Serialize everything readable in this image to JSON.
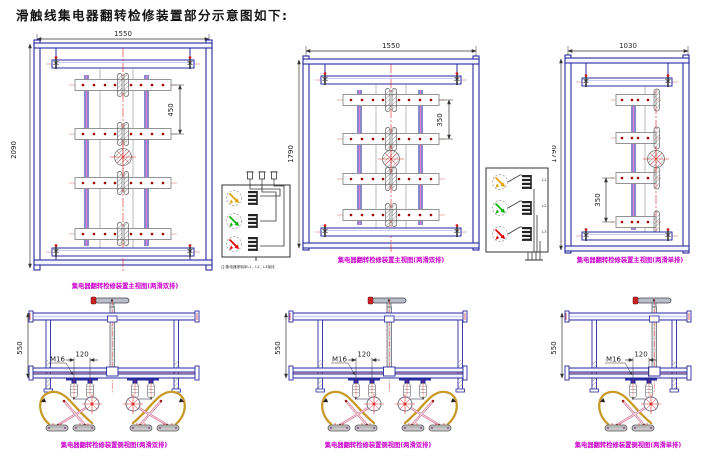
{
  "title": "滑触线集电器翻转检修装置部分示意图如下:",
  "front_views": [
    {
      "width_dim": "1550",
      "height_dim": "2090",
      "pitch_dim": "450",
      "caption": "集电器翻转检修装置主视图(两滑双排)"
    },
    {
      "width_dim": "1550",
      "height_dim": "1790",
      "pitch_dim": "350",
      "caption": "集电器翻转检修装置主视图(两滑双排)"
    },
    {
      "width_dim": "1030",
      "height_dim": "1790",
      "pitch_dim": "350",
      "caption": "集电器翻转检修装置主视图(两滑单排)"
    }
  ],
  "side_views": [
    {
      "height_dim": "550",
      "bolt_label": "M16",
      "spacing_dim": "120",
      "caption": "集电器翻转检修装置侧视图(两滑双排)"
    },
    {
      "height_dim": "550",
      "bolt_label": "M16",
      "spacing_dim": "120",
      "caption": "集电器翻转检修装置侧视图(两滑双排)"
    },
    {
      "height_dim": "550",
      "bolt_label": "M16",
      "spacing_dim": "120",
      "caption": "集电器翻转检修装置侧视图(两滑单排)"
    }
  ],
  "detail_views": {
    "note": "注:集电器按相序L1、L2、L3接线",
    "phases": [
      {
        "label": "L1",
        "color": "#e0a000"
      },
      {
        "label": "L2",
        "color": "#00b000"
      },
      {
        "label": "L3",
        "color": "#e00000"
      }
    ]
  },
  "colors": {
    "frame": "#2a2aa0",
    "rail_accent": "#cc44cc",
    "centerline": "#dd2222",
    "caption": "#cc00cc",
    "cable": "#c79b2a",
    "dimension": "#333333"
  }
}
